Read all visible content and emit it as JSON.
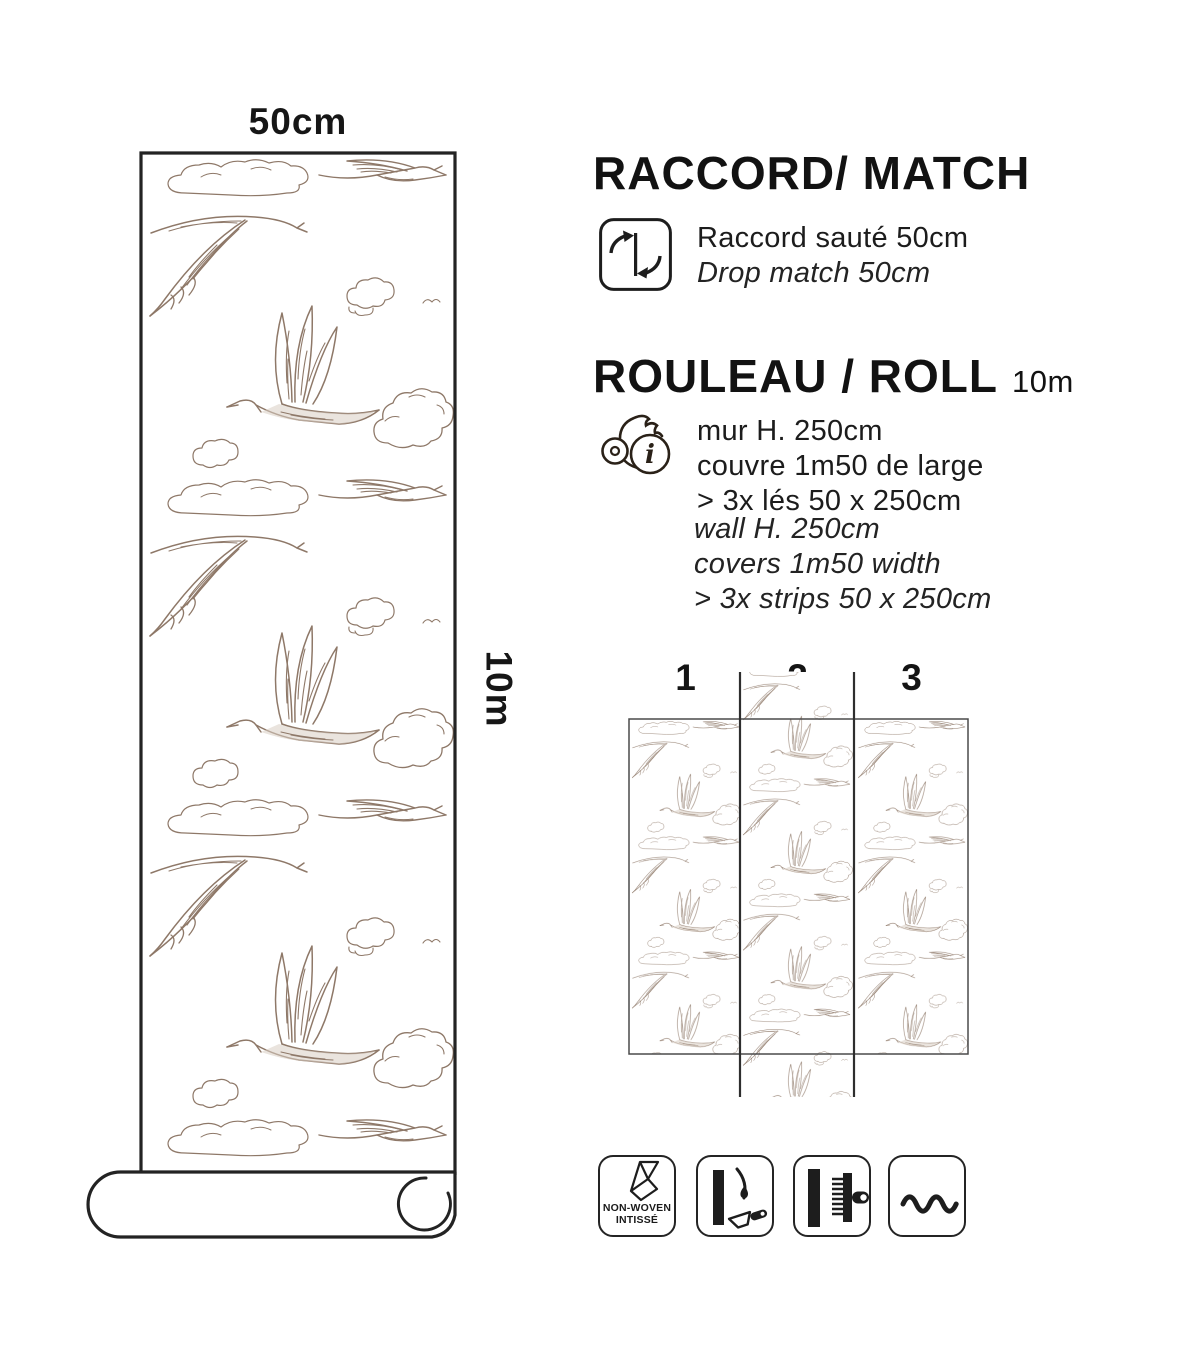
{
  "roll_preview": {
    "width_label": "50cm",
    "length_label": "10m"
  },
  "match_section": {
    "title": "RACCORD/ MATCH",
    "line_fr": "Raccord sauté 50cm",
    "line_en": "Drop match 50cm"
  },
  "roll_section": {
    "title": "ROULEAU / ROLL",
    "length": "10m",
    "info_glyph": "i",
    "fr_lines": [
      "mur H. 250cm",
      "couvre 1m50 de large",
      "> 3x lés 50 x 250cm"
    ],
    "en_lines": [
      "wall H. 250cm",
      "covers 1m50 width",
      "> 3x strips 50 x 250cm"
    ]
  },
  "strip_diagram": {
    "numbers": [
      "1",
      "2",
      "3"
    ]
  },
  "feature_icons": {
    "non_woven_line1": "NON-WOVEN",
    "non_woven_line2": "INTISSÉ"
  },
  "colors": {
    "pattern_sepia": "#8e7868",
    "ink": "#1d1d1d"
  }
}
